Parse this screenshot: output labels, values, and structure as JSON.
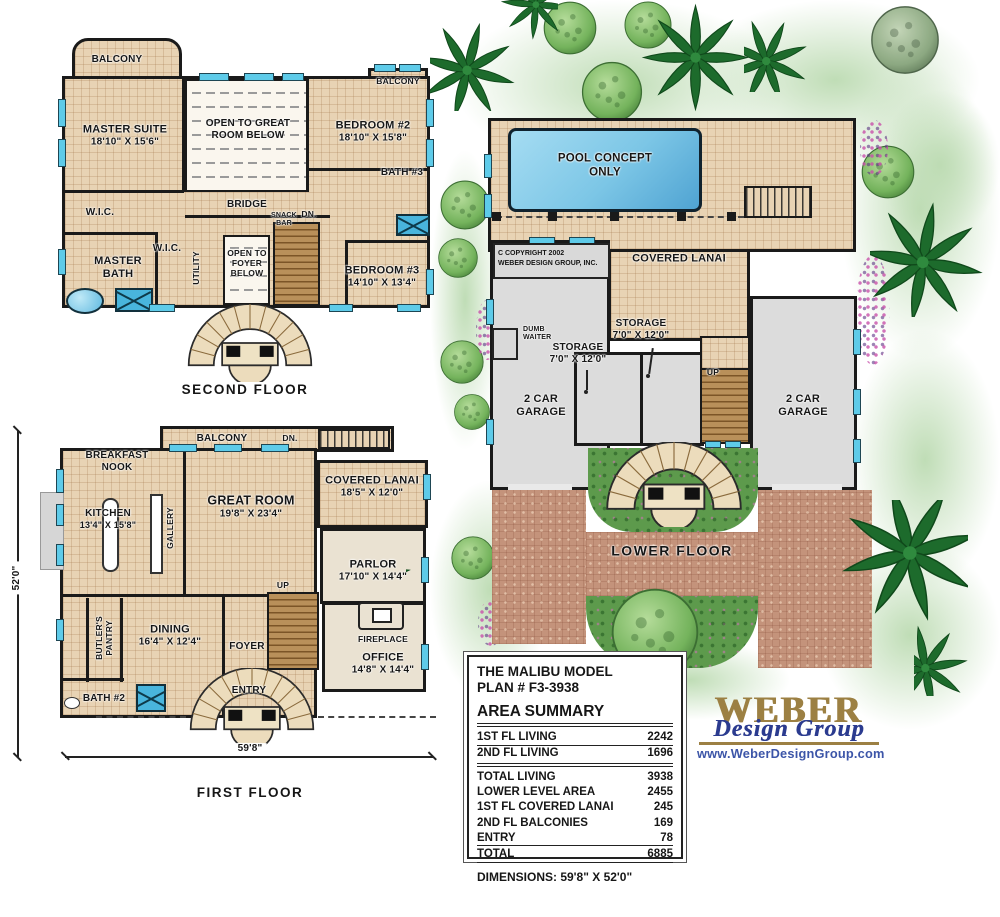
{
  "second_floor": {
    "title": "SECOND FLOOR",
    "balcony_left": "BALCONY",
    "balcony_right": "BALCONY",
    "master_suite": "MASTER SUITE",
    "master_suite_dims": "18'10\" X 15'6\"",
    "open_great_room": "OPEN TO GREAT ROOM BELOW",
    "bedroom2": "BEDROOM #2",
    "bedroom2_dims": "18'10\" X 15'8\"",
    "bath3": "BATH #3",
    "wic_left": "W.I.C.",
    "wic_right": "W.I.C.",
    "master_bath": "MASTER BATH",
    "utility": "UTILITY",
    "bridge": "BRIDGE",
    "snack_bar": "SNACK BAR",
    "dn": "DN.",
    "open_foyer": "OPEN TO FOYER BELOW",
    "bedroom3": "BEDROOM #3",
    "bedroom3_dims": "14'10\" X 13'4\""
  },
  "first_floor": {
    "title": "FIRST FLOOR",
    "balcony": "BALCONY",
    "balcony_dn": "DN.",
    "breakfast_nook": "BREAKFAST NOOK",
    "kitchen": "KITCHEN",
    "kitchen_dims": "13'4\" X 15'8\"",
    "gallery": "GALLERY",
    "great_room": "GREAT ROOM",
    "great_room_dims": "19'8\" X 23'4\"",
    "covered_lanai": "COVERED LANAI",
    "covered_lanai_dims": "18'5\" X 12'0\"",
    "parlor": "PARLOR",
    "parlor_dims": "17'10\" X 14'4\"",
    "up": "UP",
    "butlers_pantry": "BUTLER'S PANTRY",
    "dining": "DINING",
    "dining_dims": "16'4\" X 12'4\"",
    "foyer": "FOYER",
    "fireplace": "FIREPLACE",
    "office": "OFFICE",
    "office_dims": "14'8\" X 14'4\"",
    "bath2": "BATH #2",
    "entry": "ENTRY",
    "width_dim": "59'8\"",
    "height_dim": "52'0\""
  },
  "lower_floor": {
    "title": "LOWER FLOOR",
    "pool": "POOL CONCEPT ONLY",
    "copyright_1": "C COPYRIGHT 2002",
    "copyright_2": "WEBER DESIGN GROUP, INC.",
    "covered_lanai": "COVERED LANAI",
    "dumb_waiter": "DUMB WAITER",
    "storage_a": "STORAGE",
    "storage_a_dims": "7'0\" X 12'0\"",
    "storage_b": "STORAGE",
    "storage_b_dims": "7'0\" X 12'0\"",
    "garage_left": "2 CAR GARAGE",
    "garage_right": "2 CAR GARAGE",
    "up": "UP"
  },
  "info_box": {
    "model": "THE MALIBU MODEL",
    "plan": "PLAN # F3-3938",
    "section_title": "AREA SUMMARY",
    "rows": [
      {
        "label": "1ST FL LIVING",
        "value": "2242"
      },
      {
        "label": "2ND FL LIVING",
        "value": "1696"
      },
      {
        "label": "TOTAL LIVING",
        "value": "3938"
      },
      {
        "label": "LOWER LEVEL AREA",
        "value": "2455"
      },
      {
        "label": "1ST FL COVERED LANAI",
        "value": "245"
      },
      {
        "label": "2ND FL BALCONIES",
        "value": "169"
      },
      {
        "label": "ENTRY",
        "value": "78"
      },
      {
        "label": "TOTAL",
        "value": "6885"
      }
    ],
    "dimensions": "DIMENSIONS: 59'8\" X 52'0\""
  },
  "logo": {
    "brand": "WEBER",
    "subbrand": "Design Group",
    "website": "www.WeberDesignGroup.com"
  }
}
